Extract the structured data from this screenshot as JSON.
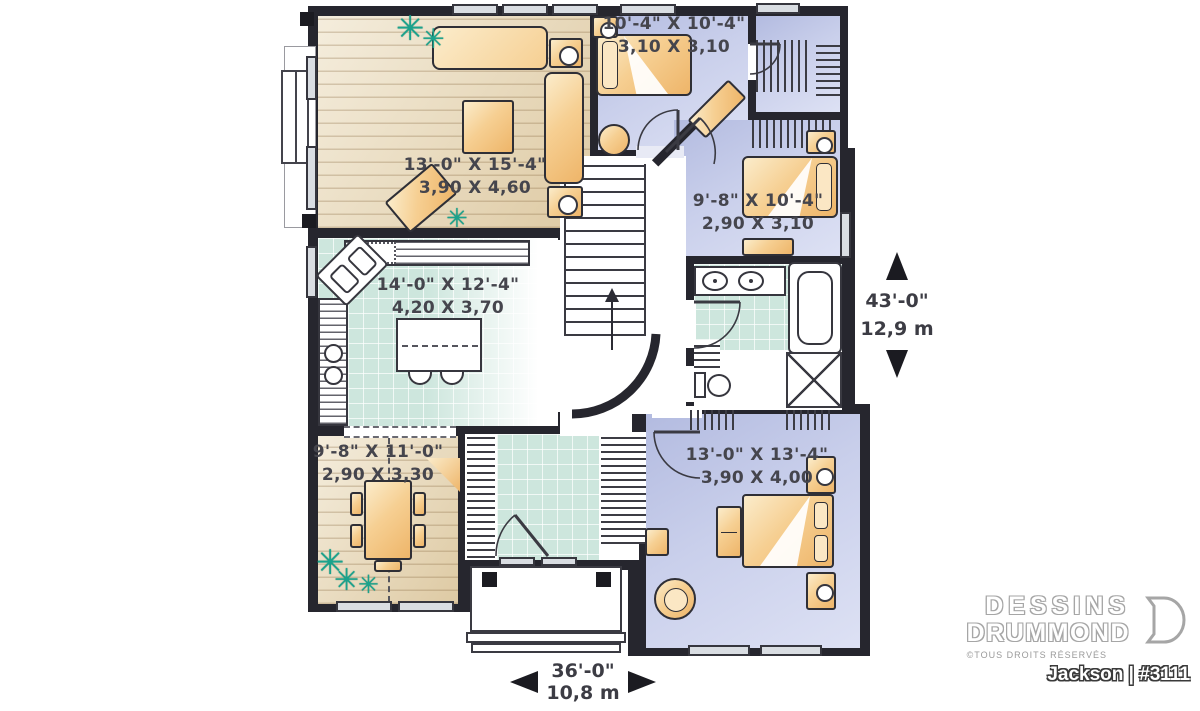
{
  "plan": {
    "rooms": [
      {
        "id": "living-room",
        "imperial": "13'-0\" X 15'-4\"",
        "metric": "3,90 X 4,60"
      },
      {
        "id": "bedroom-2",
        "imperial": "10'-4\" X 10'-4\"",
        "metric": "3,10 X 3,10"
      },
      {
        "id": "bedroom-3",
        "imperial": "9'-8\" X 10'-4\"",
        "metric": "2,90 X 3,10"
      },
      {
        "id": "kitchen",
        "imperial": "14'-0\" X 12'-4\"",
        "metric": "4,20 X 3,70"
      },
      {
        "id": "dining-room",
        "imperial": "9'-8\" X 11'-0\"",
        "metric": "2,90 X 3,30"
      },
      {
        "id": "master-bedroom",
        "imperial": "13'-0\" X 13'-4\"",
        "metric": "3,90 X 4,00"
      }
    ],
    "overall_dimensions": {
      "depth_imperial": "43'-0\"",
      "depth_metric": "12,9 m",
      "width_imperial": "36'-0\"",
      "width_metric": "10,8 m"
    }
  },
  "branding": {
    "company_line1": "DESSINS",
    "company_line2": "DRUMMOND",
    "rights": "©TOUS DROITS RÉSERVÉS",
    "plan_name": "Jackson | #3111"
  },
  "icons": {
    "plant": "✳"
  },
  "colors": {
    "walls": "#26262e",
    "bedroom_floor": "#c9cfeb",
    "tile_floor": "#cde6dd",
    "wood_floor": "#eadbba",
    "furniture": "#f6cf92",
    "plant_green": "#1aa38c"
  }
}
